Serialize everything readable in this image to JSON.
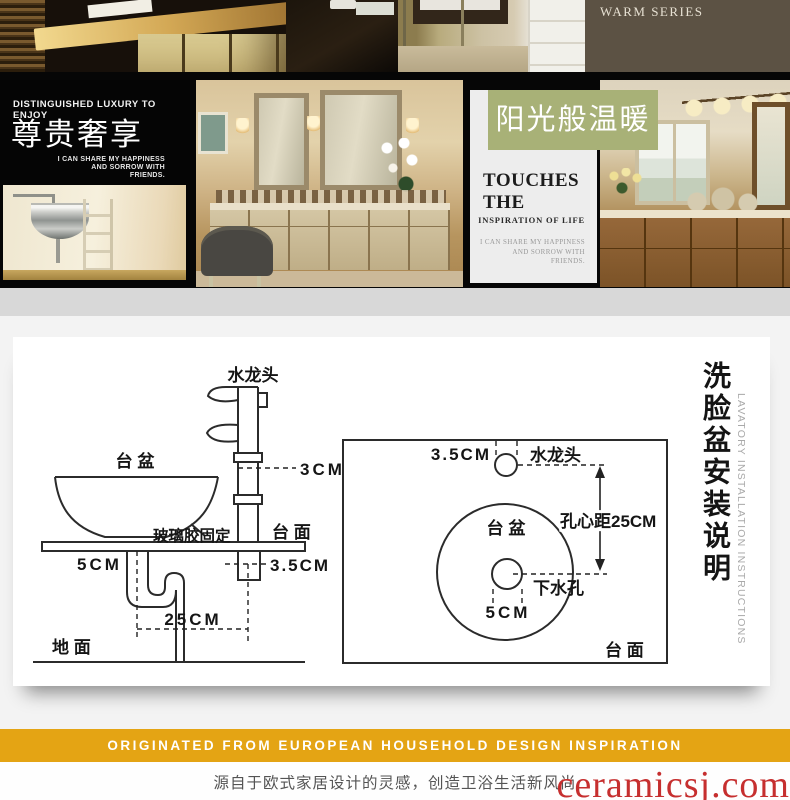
{
  "collage": {
    "warm_series_label": "WARM SERIES",
    "warm_panel_color": "#5C5244"
  },
  "luxury_panel": {
    "eyebrow": "DISTINGUISHED LUXURY TO ENJOY",
    "title": "尊贵奢享",
    "caption_lines": [
      "I CAN SHARE MY HAPPINESS",
      "AND SORROW WITH",
      "FRIENDS."
    ]
  },
  "sunshine_badge": {
    "label": "阳光般温暖",
    "color": "#A8B177"
  },
  "touches_panel": {
    "title": "TOUCHES THE",
    "subtitle": "INSPIRATION OF LIFE",
    "caption_lines": [
      "I CAN SHARE MY HAPPINESS",
      "AND SORROW WITH",
      "FRIENDS."
    ]
  },
  "diagram": {
    "title_cn": "洗脸盆安装说明",
    "title_en": "LAVATORY INSTALLATION INSTRUCTIONS",
    "side_view": {
      "faucet": "水龙头",
      "basin": "台 盆",
      "dim_3cm": "3CM",
      "glue": "玻璃胶固定",
      "counter": "台 面",
      "dim_5cm": "5CM",
      "dim_3_5cm": "3.5CM",
      "dim_25cm": "25CM",
      "floor": "地 面"
    },
    "top_view": {
      "dim_3_5cm": "3.5CM",
      "faucet": "水龙头",
      "basin": "台 盆",
      "hole_distance": "孔心距25CM",
      "drain": "下水孔",
      "dim_5cm": "5CM",
      "counter": "台 面"
    }
  },
  "footer": {
    "banner": "ORIGINATED FROM EUROPEAN HOUSEHOLD DESIGN INSPIRATION",
    "banner_color": "#E4A414",
    "tagline": "源自于欧式家居设计的灵感，创造卫浴生活新风尚",
    "watermark": "ceramicsj.com",
    "watermark_color": "#C62F2F"
  }
}
